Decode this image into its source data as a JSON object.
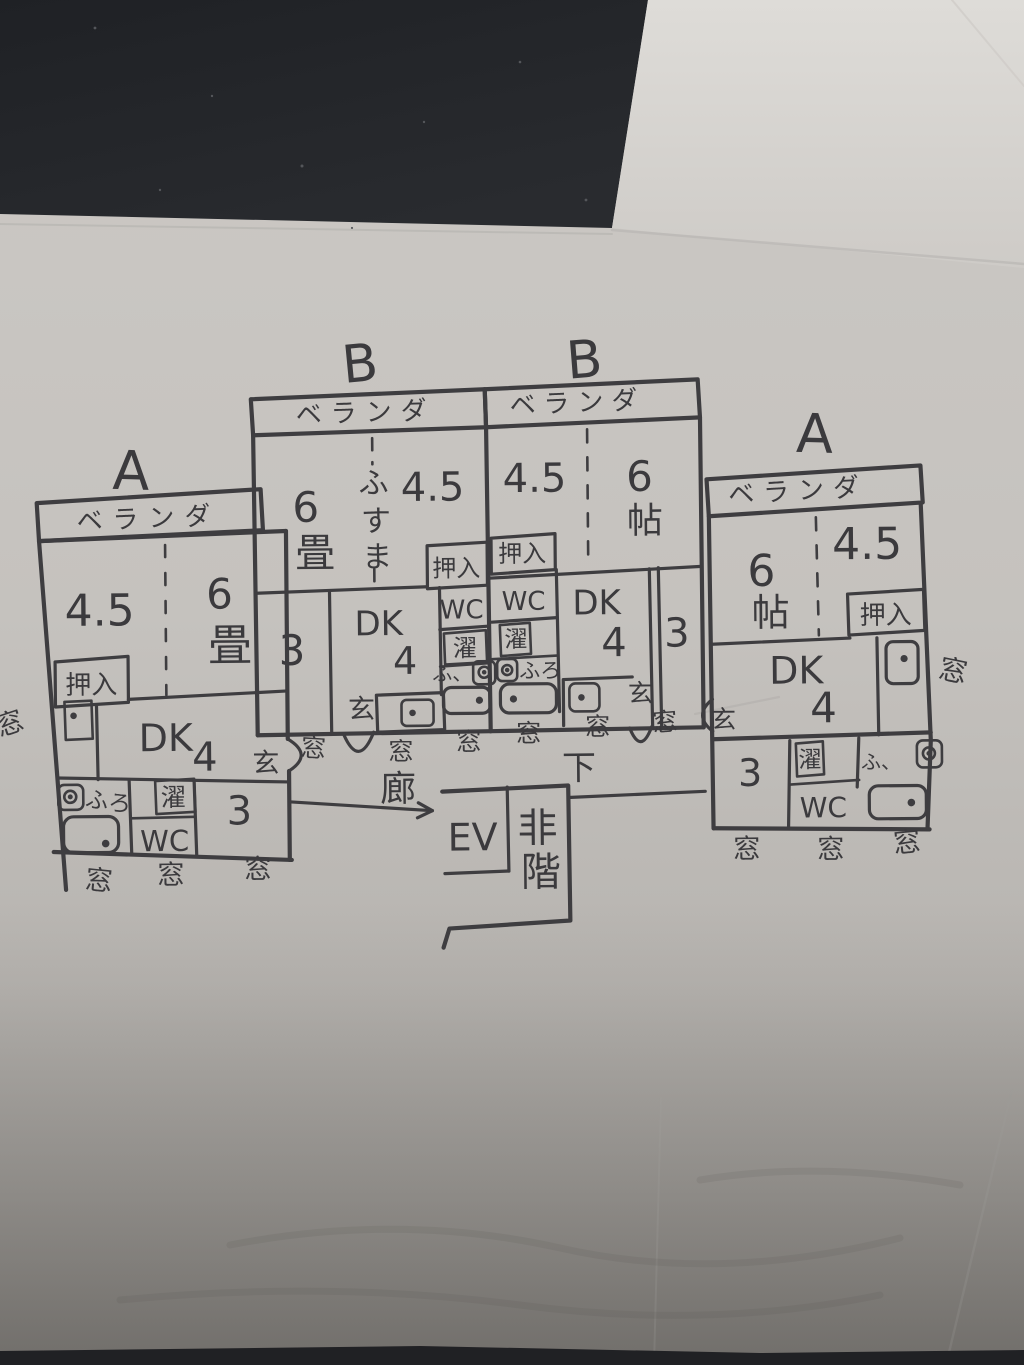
{
  "photo": {
    "description_colors": {
      "ink": "#3e3d40",
      "paper": "#c7c4c0",
      "upper_paper": "#d8d6d2",
      "dark_backdrop": "#222428"
    }
  },
  "units": {
    "a_left": {
      "label": "A",
      "veranda": "ベランダ",
      "room_45": "4.5",
      "room_6": "6畳",
      "oshiire": "押入",
      "dk": "DK",
      "dk_num": "4",
      "entrance": "玄",
      "bath": "ふろ",
      "laundry": "濯",
      "wc": "WC",
      "room_3": "3",
      "window_side": "窓",
      "windows_bottom": [
        "窓",
        "窓",
        "窓"
      ]
    },
    "b_left": {
      "label": "B",
      "veranda": "ベランダ",
      "room_6": "6畳",
      "fusuma": "ふすま",
      "room_45": "4.5",
      "oshiire": "押入",
      "room_3": "3",
      "dk": "DK",
      "dk_num": "4",
      "wc": "WC",
      "laundry": "濯",
      "bath": "ふ、",
      "entrance": "玄",
      "windows_bottom": [
        "窓",
        "窓",
        "窓"
      ]
    },
    "b_right": {
      "label": "B",
      "veranda": "ベランダ",
      "room_45": "4.5",
      "room_6": "6帖",
      "oshiire": "押入",
      "wc": "WC",
      "laundry": "濯",
      "bath": "ふろ",
      "dk": "DK",
      "dk_num": "4",
      "room_3": "3",
      "entrance": "玄",
      "windows_bottom": [
        "窓",
        "窓",
        "窓"
      ]
    },
    "a_right": {
      "label": "A",
      "veranda": "ベランダ",
      "room_6": "6帖",
      "room_45": "4.5",
      "oshiire": "押入",
      "dk": "DK",
      "dk_num": "4",
      "entrance": "玄",
      "room_3": "3",
      "laundry": "濯",
      "wc": "WC",
      "bath": "ふ、",
      "window_side": "窓",
      "windows_bottom": [
        "窓",
        "窓",
        "窓"
      ]
    }
  },
  "corridor": {
    "label_left": "廊",
    "label_right": "下"
  },
  "core": {
    "ev": "EV",
    "stairs": "非階"
  }
}
